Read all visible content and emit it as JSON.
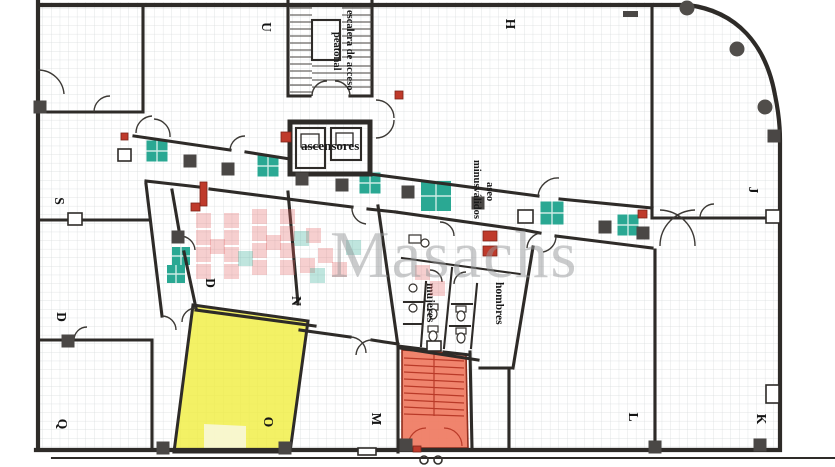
{
  "plan": {
    "type": "floor-plan-scan",
    "watermark_brand": "Masachs"
  },
  "labels": {
    "stair_line1": "escalera de acceso",
    "stair_line2": "peatonal",
    "elevators": "ascensores",
    "wc_disabled_line1": "aseo",
    "wc_disabled_line2": "minusválidos",
    "wc_men": "hombres",
    "wc_women": "mujeres"
  },
  "room_letters": [
    {
      "ch": "U",
      "x": 262,
      "y": 27
    },
    {
      "ch": "H",
      "x": 506,
      "y": 24
    },
    {
      "ch": "J",
      "x": 749,
      "y": 190
    },
    {
      "ch": "S",
      "x": 55,
      "y": 201
    },
    {
      "ch": "D",
      "x": 57,
      "y": 317
    },
    {
      "ch": "Q",
      "x": 58,
      "y": 424
    },
    {
      "ch": "D",
      "x": 206,
      "y": 283
    },
    {
      "ch": "N",
      "x": 292,
      "y": 301
    },
    {
      "ch": "O",
      "x": 264,
      "y": 422
    },
    {
      "ch": "M",
      "x": 372,
      "y": 419
    },
    {
      "ch": "L",
      "x": 629,
      "y": 417
    },
    {
      "ch": "K",
      "x": 757,
      "y": 419
    }
  ],
  "teal_tiles": [
    {
      "x": 157,
      "y": 151,
      "s": 21
    },
    {
      "x": 268,
      "y": 166,
      "s": 21
    },
    {
      "x": 370,
      "y": 183,
      "s": 21
    },
    {
      "x": 436,
      "y": 196,
      "s": 30
    },
    {
      "x": 552,
      "y": 213,
      "s": 23
    },
    {
      "x": 628,
      "y": 225,
      "s": 21
    },
    {
      "x": 181,
      "y": 256,
      "s": 18
    },
    {
      "x": 176,
      "y": 274,
      "s": 18
    }
  ],
  "pillars": [
    {
      "x": 190,
      "y": 161
    },
    {
      "x": 228,
      "y": 169
    },
    {
      "x": 302,
      "y": 179
    },
    {
      "x": 342,
      "y": 185
    },
    {
      "x": 408,
      "y": 192
    },
    {
      "x": 478,
      "y": 203
    },
    {
      "x": 605,
      "y": 227
    },
    {
      "x": 643,
      "y": 233
    },
    {
      "x": 178,
      "y": 237
    },
    {
      "x": 40,
      "y": 107
    },
    {
      "x": 68,
      "y": 341
    },
    {
      "x": 285,
      "y": 448
    },
    {
      "x": 163,
      "y": 448
    },
    {
      "x": 406,
      "y": 445
    },
    {
      "x": 655,
      "y": 447
    },
    {
      "x": 760,
      "y": 445
    },
    {
      "x": 774,
      "y": 136
    }
  ],
  "bars": [
    {
      "x": 623,
      "y": 11,
      "w": 15,
      "h": 6
    }
  ],
  "round_pillars": [
    {
      "x": 687,
      "y": 8
    },
    {
      "x": 737,
      "y": 49
    },
    {
      "x": 765,
      "y": 107
    }
  ],
  "red_marks": [
    {
      "x": 200,
      "y": 182,
      "w": 7,
      "h": 24
    },
    {
      "x": 191,
      "y": 203,
      "w": 9,
      "h": 8
    },
    {
      "x": 281,
      "y": 132,
      "w": 10,
      "h": 10
    },
    {
      "x": 395,
      "y": 91,
      "w": 8,
      "h": 8
    },
    {
      "x": 638,
      "y": 210,
      "w": 9,
      "h": 8
    },
    {
      "x": 483,
      "y": 231,
      "w": 14,
      "h": 10
    },
    {
      "x": 483,
      "y": 246,
      "w": 14,
      "h": 10
    },
    {
      "x": 413,
      "y": 446,
      "w": 8,
      "h": 6
    },
    {
      "x": 121,
      "y": 133,
      "w": 7,
      "h": 7
    }
  ],
  "watermark_cells_pink": [
    {
      "x": 196,
      "y": 213
    },
    {
      "x": 196,
      "y": 230
    },
    {
      "x": 196,
      "y": 247
    },
    {
      "x": 196,
      "y": 264
    },
    {
      "x": 224,
      "y": 213
    },
    {
      "x": 224,
      "y": 230
    },
    {
      "x": 224,
      "y": 247
    },
    {
      "x": 224,
      "y": 264
    },
    {
      "x": 210,
      "y": 239
    },
    {
      "x": 252,
      "y": 209
    },
    {
      "x": 252,
      "y": 226
    },
    {
      "x": 252,
      "y": 243
    },
    {
      "x": 252,
      "y": 260
    },
    {
      "x": 280,
      "y": 209
    },
    {
      "x": 280,
      "y": 226
    },
    {
      "x": 280,
      "y": 243
    },
    {
      "x": 280,
      "y": 260
    },
    {
      "x": 266,
      "y": 235
    },
    {
      "x": 306,
      "y": 228
    },
    {
      "x": 318,
      "y": 248
    },
    {
      "x": 332,
      "y": 262
    },
    {
      "x": 300,
      "y": 258
    },
    {
      "x": 415,
      "y": 265
    },
    {
      "x": 430,
      "y": 281
    }
  ],
  "watermark_cells_teal": [
    {
      "x": 238,
      "y": 251
    },
    {
      "x": 294,
      "y": 231
    },
    {
      "x": 310,
      "y": 268
    },
    {
      "x": 346,
      "y": 240
    }
  ],
  "bottom_circles": [
    {
      "x": 424,
      "y": 460
    },
    {
      "x": 438,
      "y": 460
    }
  ],
  "colors": {
    "wall": "#2e2b28",
    "grid": "#d7dadc",
    "teal": "#2aa893",
    "pillar": "#4a4745",
    "yellow": "#f0ee3e",
    "pale": "#f8f7d8",
    "stairs": "#ef7a61",
    "stairsline": "#b93a28",
    "red": "#bf3a2b",
    "wmgray": "#97999b",
    "wmpink": "#e06060"
  }
}
